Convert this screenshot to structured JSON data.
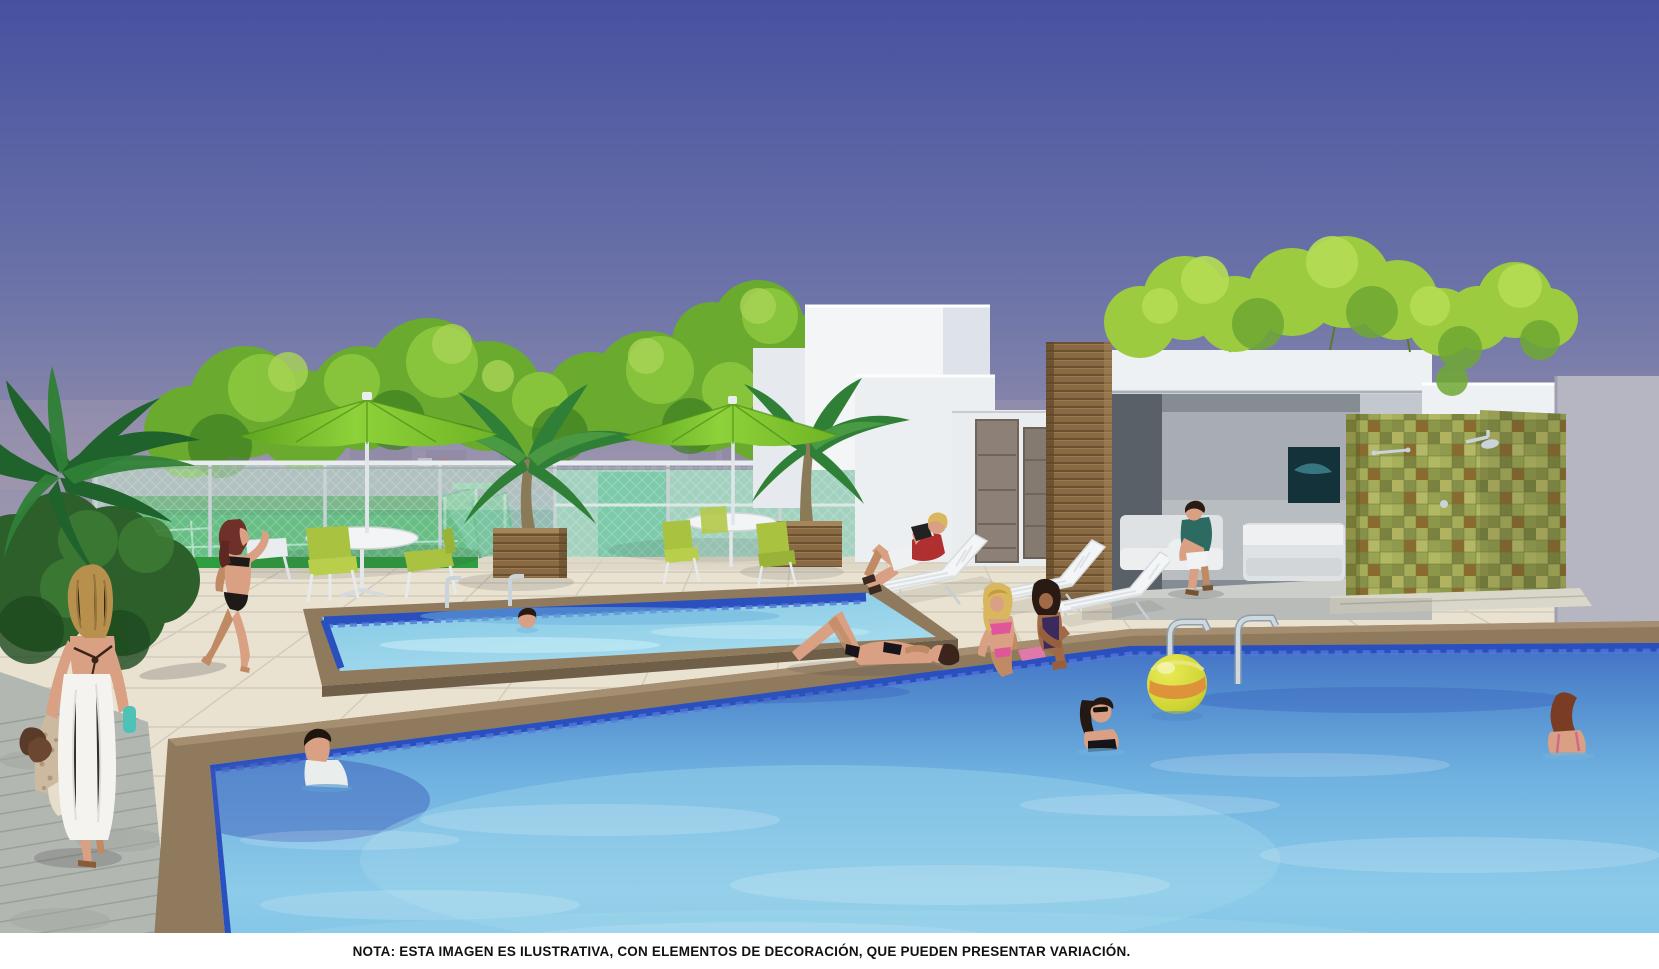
{
  "note": {
    "text": "NOTA: ESTA  IMAGEN ES ILUSTRATIVA, CON ELEMENTOS  DE DECORACIÓN, QUE PUEDEN PRESENTAR VARIACIÓN."
  },
  "scene": {
    "type": "architectural-rendering",
    "setting": "condominium rooftop leisure deck with two swimming pools",
    "palette": {
      "sky-top": "#4651a0",
      "sky-horizon": "#a9a0b2",
      "umbrella-green": "#7cc22c",
      "court-green": "#2f9e3f",
      "fence-glass": "#8fd4b4",
      "tile-olive": "#9aa24e",
      "wood": "#8a6a45",
      "coping": "#8f7a5e",
      "deck-beige": "#e9e2d1",
      "plank": "#b2b7b1",
      "water-deep": "#2e55b8",
      "water-light": "#8cc8e8",
      "ball-yellow": "#cfd435",
      "ball-orange": "#de8b3a",
      "caption-bg": "#ffffff",
      "caption-text": "#111111"
    },
    "elements": {
      "large-pool": "large swimming pool with dark blue waterline tiles and tan stone coping",
      "kids-pool": "smaller shallow pool with chrome hand rails",
      "umbrellas": "two lime green patio umbrellas with white poles",
      "tables": "two white round tables with lime green chairs",
      "planters": "wooden box planters with palm trees",
      "loungers": "white slatted sun loungers",
      "cabana": "covered lounge with white sofas and dark wall artwork",
      "shower-wall": "olive green mosaic tile wall with outdoor shower",
      "sport-court": "green multi-sport court behind green mesh fence",
      "playground": "translucent green slide structure",
      "beach-ball": "yellow and orange inflatable ball floating in the pool"
    },
    "people": [
      {
        "id": "towel-woman",
        "description": "blonde woman wrapped in a white towel carrying sandals and a beach towel"
      },
      {
        "id": "walking-woman",
        "description": "red-haired woman in black bikini walking by the court"
      },
      {
        "id": "reading-woman",
        "description": "woman in red top reading a book on a lounger"
      },
      {
        "id": "lying-woman",
        "description": "woman in black bikini sunbathing on the deck"
      },
      {
        "id": "sitting-blonde",
        "description": "blonde woman in pink bikini sitting at the pool edge"
      },
      {
        "id": "sitting-brunette",
        "description": "woman in dark swimsuit sitting at the pool edge"
      },
      {
        "id": "sofa-man",
        "description": "man in teal shirt seated in the covered lounge"
      },
      {
        "id": "pool-man",
        "description": "man in white shirt in the large pool"
      },
      {
        "id": "pool-woman-sunglasses",
        "description": "woman wearing sunglasses in the large pool"
      },
      {
        "id": "pool-woman-right",
        "description": "woman with ponytail in the large pool"
      },
      {
        "id": "boy-kids-pool",
        "description": "boy swimming in the kids pool"
      }
    ]
  }
}
